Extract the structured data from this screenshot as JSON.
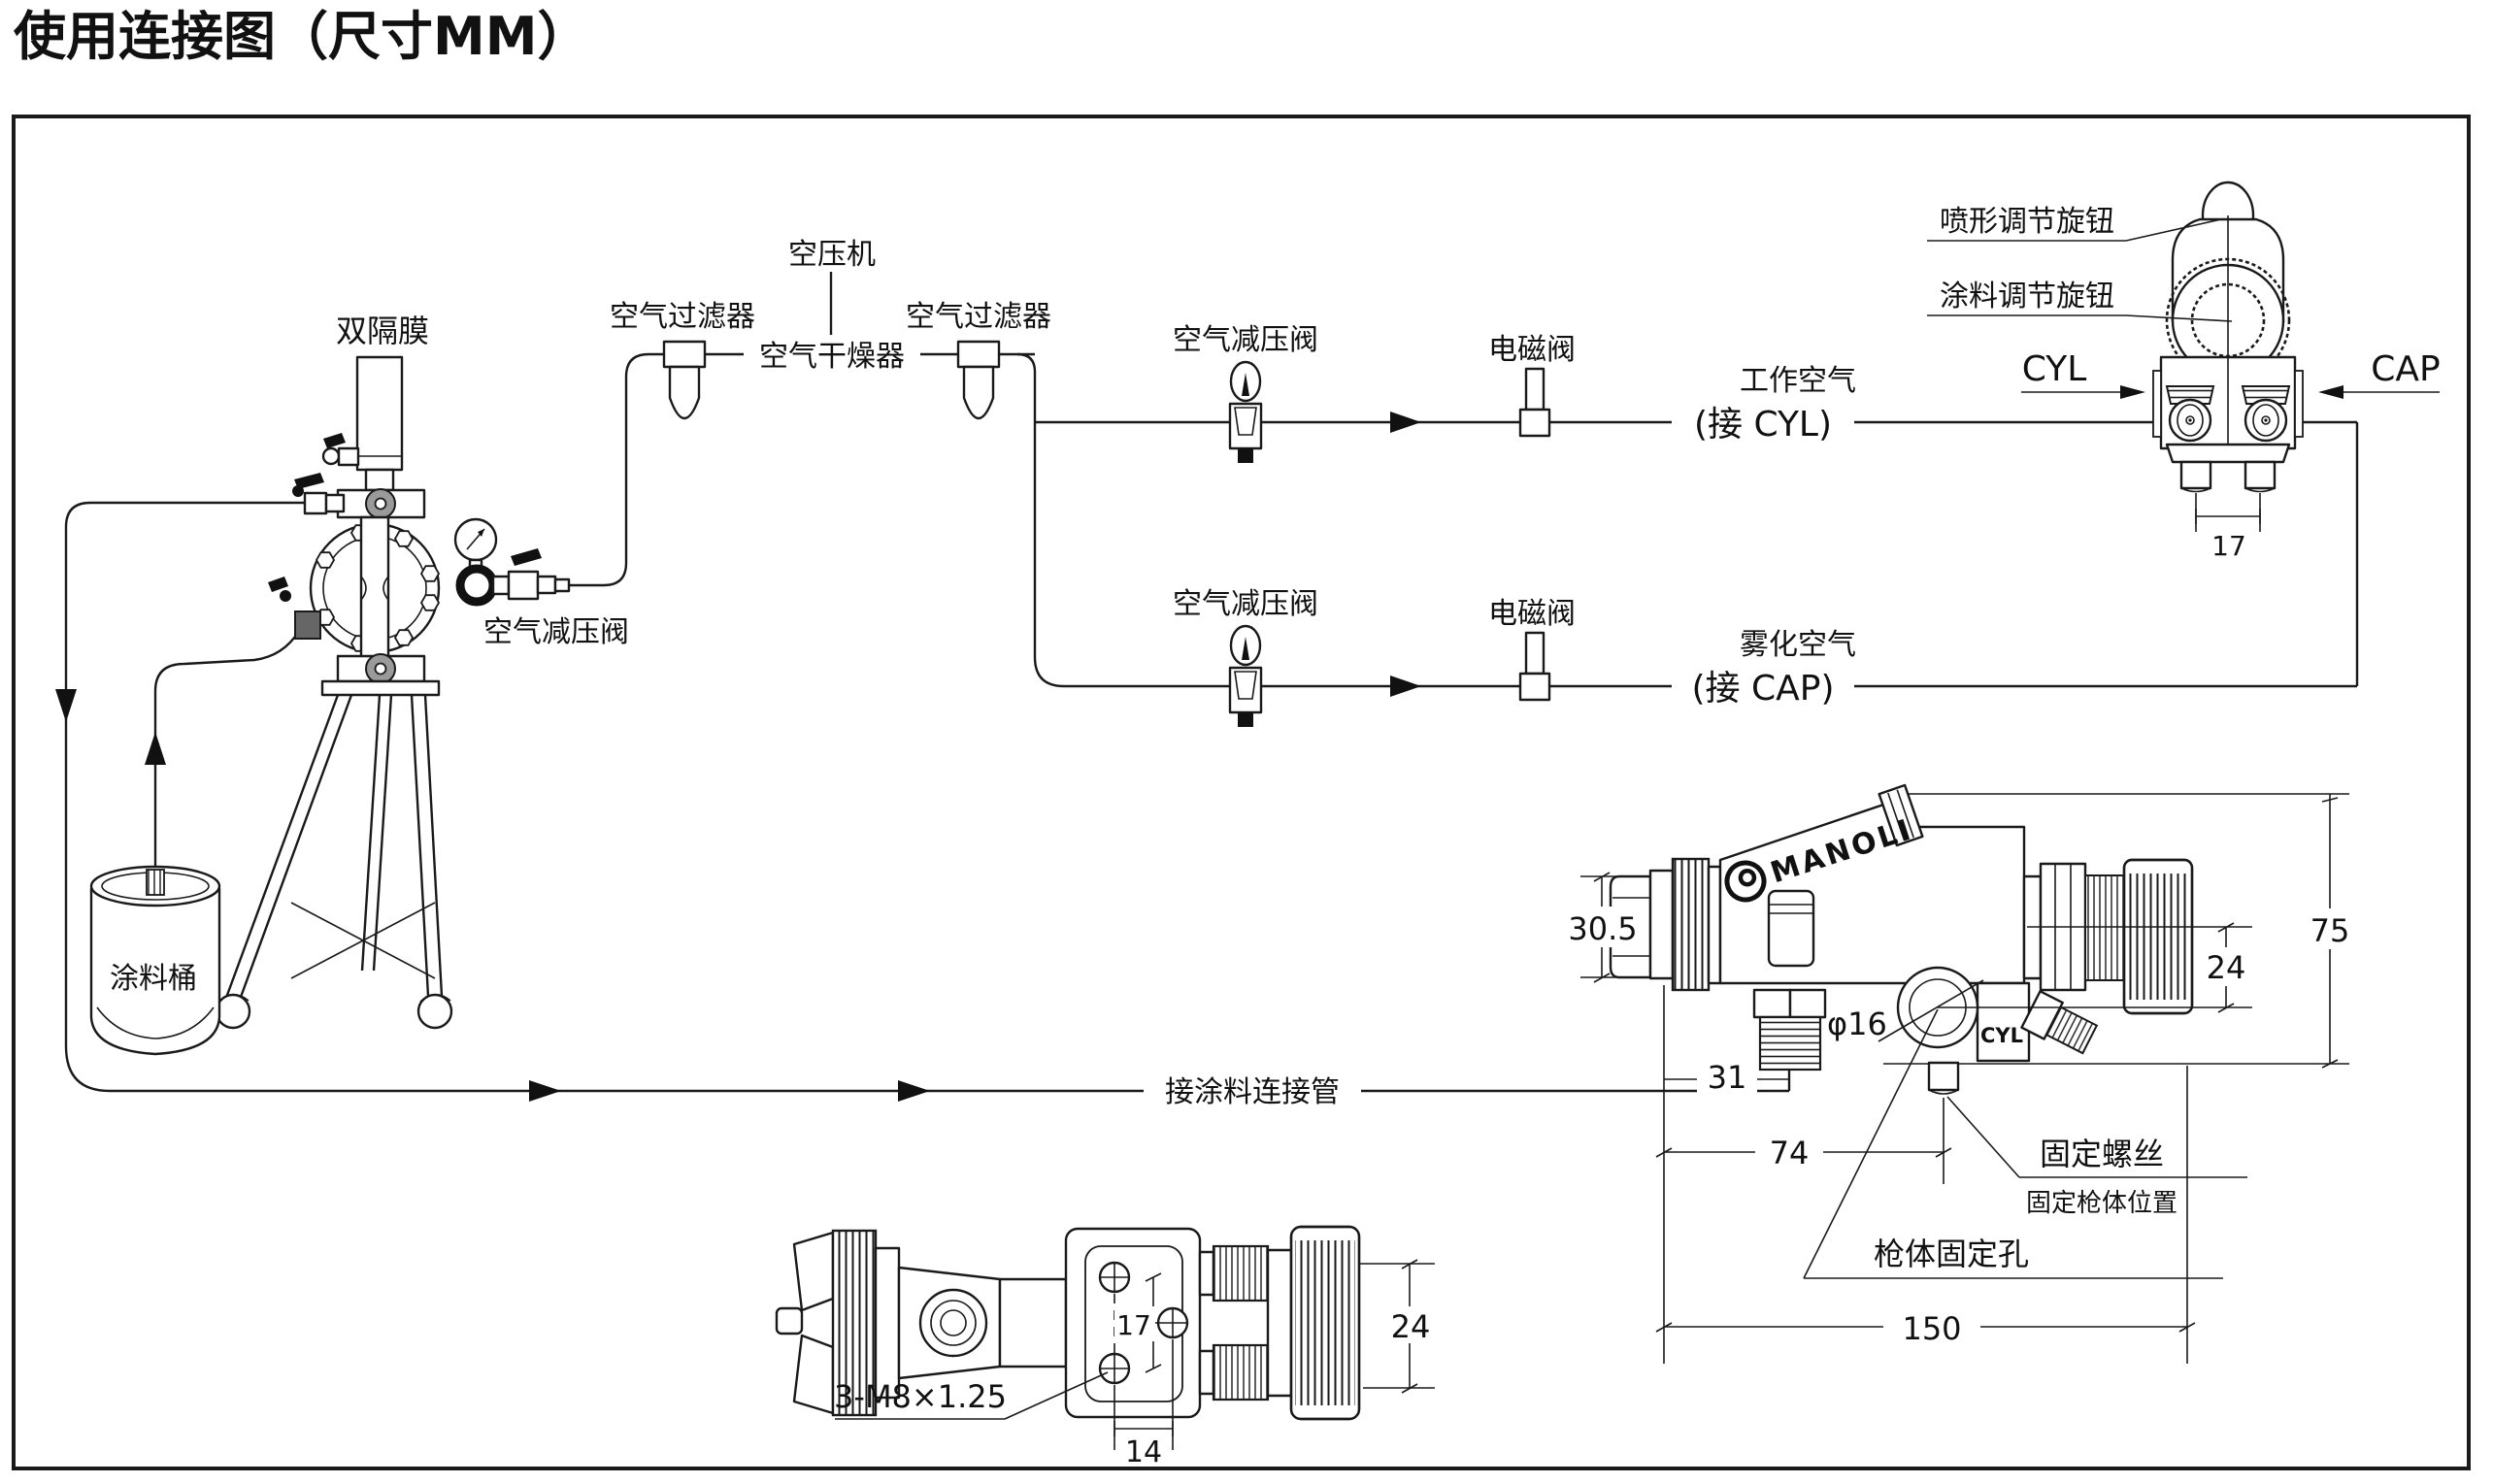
{
  "title": "使用连接图（尺寸MM）",
  "colors": {
    "line": "#1a1a1a",
    "paper": "#ffffff",
    "hub_gray": "#9a9a9a"
  },
  "supply": {
    "compressor": "空压机",
    "filter_left": "空气过滤器",
    "filter_right": "空气过滤器",
    "dryer": "空气干燥器"
  },
  "pump": {
    "name": "双隔膜",
    "regulator": "空气减压阀",
    "bucket": "涂料桶",
    "paint_line": "接涂料连接管"
  },
  "row_work": {
    "regulator": "空气减压阀",
    "solenoid": "电磁阀",
    "air": "工作空气",
    "connect": "(接  CYL)"
  },
  "row_atomize": {
    "regulator": "空气减压阀",
    "solenoid": "电磁阀",
    "air": "雾化空气",
    "connect": "(接  CAP)"
  },
  "gun_front": {
    "knob_pattern": "喷形调节旋钮",
    "knob_paint": "涂料调节旋钮",
    "cyl": "CYL",
    "cap": "CAP",
    "dim_pins": "17"
  },
  "gun_side": {
    "brand": "MANOLI",
    "cyl_port": "CYL",
    "hole_dia": "φ16",
    "dim_cap": "30.5",
    "dim_nipple": "31",
    "dim_hole": "74",
    "dim_total": "150",
    "dim_height": "75",
    "dim_knob": "24",
    "screw": "固定螺丝",
    "screw_note": "固定枪体位置",
    "mount_hole": "枪体固定孔"
  },
  "gun_bottom": {
    "dim_holes": "17",
    "dim_side_hole": "14",
    "dim_knob": "24",
    "thread_spec": "3-M8×1.25"
  }
}
